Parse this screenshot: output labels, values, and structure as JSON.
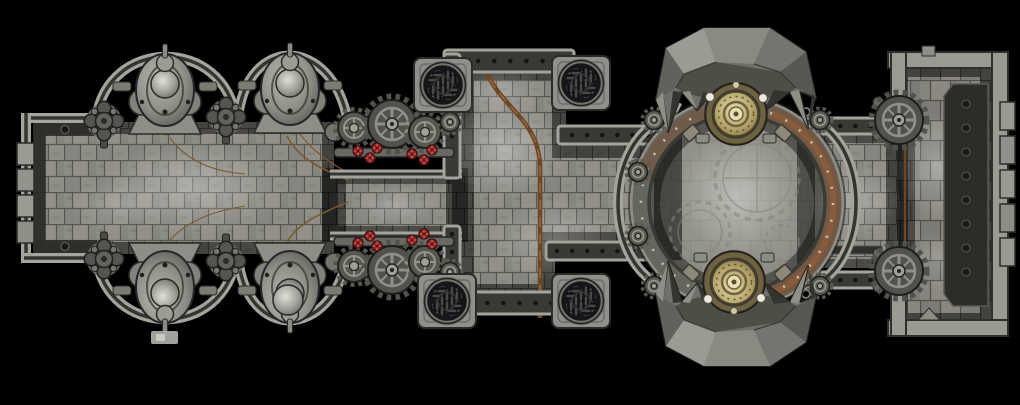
{
  "meta": {
    "title": "Industrial gothic corridor battle map, top-down view on black void",
    "type": "battle-map",
    "view": "top-down",
    "canvas": {
      "width": 1020,
      "height": 405
    }
  },
  "palette": {
    "background": "#000000",
    "floor": "#8c8b84",
    "grout": "#56554e",
    "wall-light": "#a4a49d",
    "wall-dark": "#35352f",
    "band": "#3a3a35",
    "metal-mid": "#8f8f88",
    "rust": "#7c4a2b",
    "copper": "#6d4628",
    "brass": "#b3a268",
    "hazard-red": "#952222",
    "rivet": "#141411",
    "crystal-light": "#9b9b94",
    "crystal-dark": "#35352f"
  },
  "features": {
    "left_chamber": "tiled chamber with machinery alcoves and gothic cross bosses",
    "machinery_pod_count": 4,
    "gothic_cross_count": 4,
    "gear_cluster_count": 2,
    "steam_vent_count": 4,
    "central_hall": "wide tiled hall crossed by a copper conduit",
    "arena": "circular riveted arena ring with etched gear floor",
    "crystal_canopy_count": 2,
    "brass_capacitor_count": 2,
    "connector": "east corridor flanked by wall gears",
    "right_room": "armored chamber with bolted side panel and crenellated edge"
  }
}
